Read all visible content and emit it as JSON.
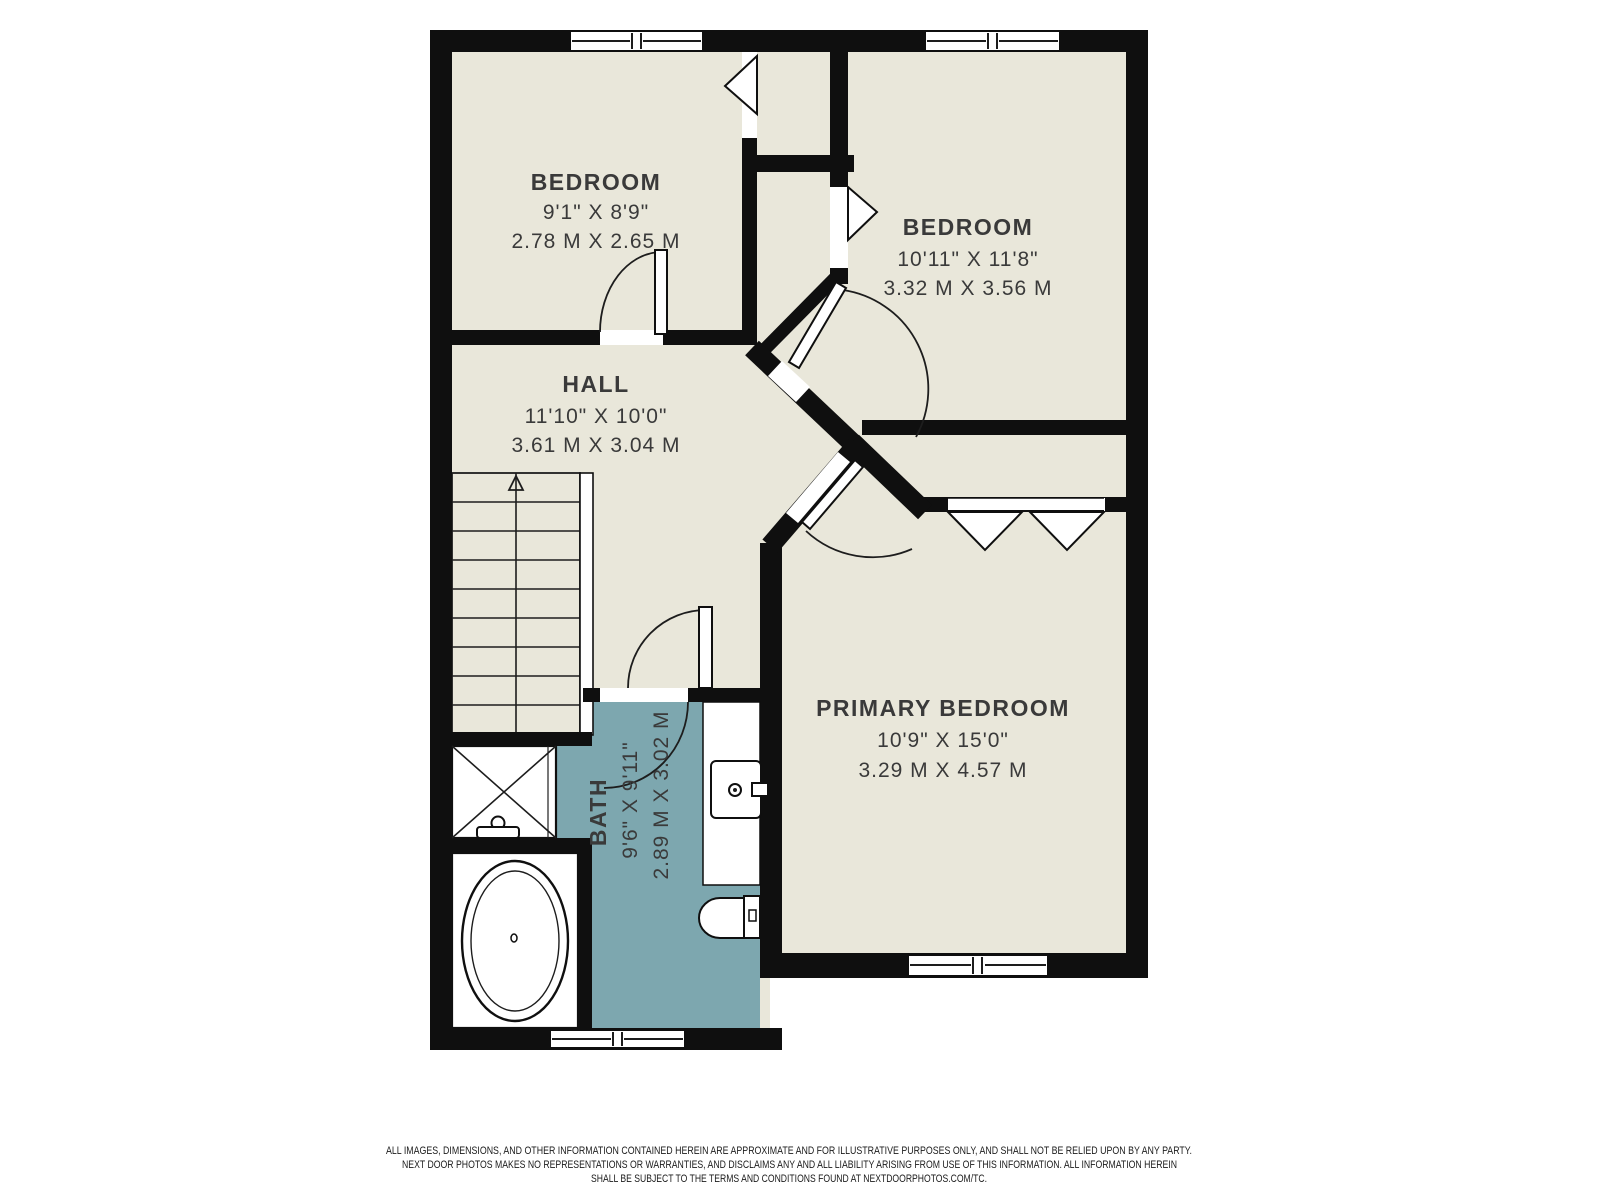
{
  "floor_plan": {
    "colors": {
      "floor": "#e9e7da",
      "bath_floor": "#7da7af",
      "wall": "#0f0f0f",
      "fixture_fill": "#ffffff",
      "label_text": "#3a3a3a"
    },
    "rooms": {
      "bedroom_top_left": {
        "name": "BEDROOM",
        "imperial": "9'1\" X 8'9\"",
        "metric": "2.78 M X 2.65 M"
      },
      "bedroom_top_right": {
        "name": "BEDROOM",
        "imperial": "10'11\" X 11'8\"",
        "metric": "3.32 M X 3.56 M"
      },
      "hall": {
        "name": "HALL",
        "imperial": "11'10\" X 10'0\"",
        "metric": "3.61 M X 3.04 M"
      },
      "bath": {
        "name": "BATH",
        "imperial": "9'6\" X 9'11\"",
        "metric": "2.89 M X 3.02 M"
      },
      "primary_bedroom": {
        "name": "PRIMARY BEDROOM",
        "imperial": "10'9\" X 15'0\"",
        "metric": "3.29 M X 4.57 M"
      }
    },
    "fixtures": [
      "stairs-up",
      "shower",
      "bathtub",
      "vanity-sink",
      "toilet"
    ],
    "disclaimer": {
      "line1": "ALL IMAGES, DIMENSIONS, AND OTHER INFORMATION CONTAINED HEREIN ARE APPROXIMATE AND FOR ILLUSTRATIVE PURPOSES ONLY, AND SHALL NOT BE RELIED UPON BY ANY PARTY.",
      "line2": "NEXT DOOR PHOTOS MAKES NO REPRESENTATIONS OR WARRANTIES, AND DISCLAIMS ANY AND ALL LIABILITY ARISING FROM USE OF THIS INFORMATION. ALL INFORMATION HEREIN",
      "line3": "SHALL BE SUBJECT TO THE TERMS AND CONDITIONS FOUND AT NEXTDOORPHOTOS.COM/TC."
    }
  }
}
